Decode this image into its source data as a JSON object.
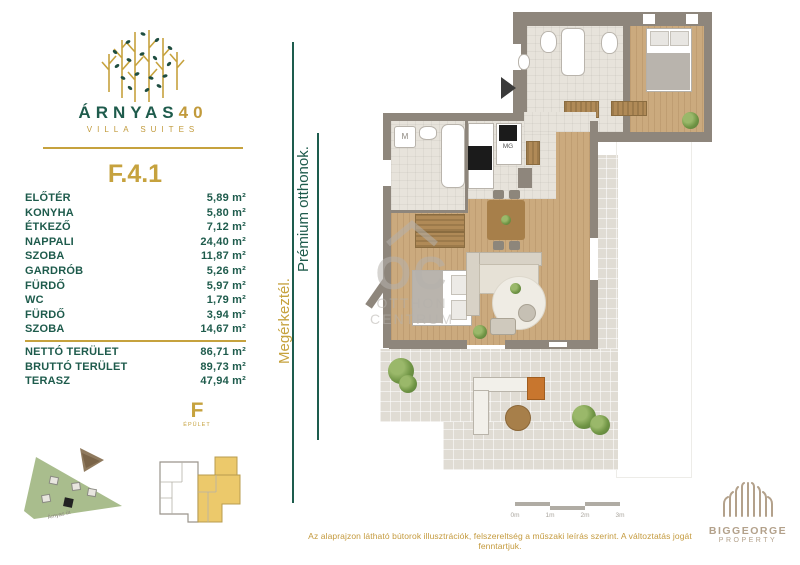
{
  "brand": {
    "name": "ÁRNYAS",
    "number": "40",
    "subtitle": "VILLA SUITES"
  },
  "unit": {
    "id": "F.4.1"
  },
  "rooms": [
    {
      "label": "ELŐTÉR",
      "value": "5,89 m²"
    },
    {
      "label": "KONYHA",
      "value": "5,80 m²"
    },
    {
      "label": "ÉTKEZŐ",
      "value": "7,12 m²"
    },
    {
      "label": "NAPPALI",
      "value": "24,40 m²"
    },
    {
      "label": "SZOBA",
      "value": "11,87 m²"
    },
    {
      "label": "GARDRÓB",
      "value": "5,26 m²"
    },
    {
      "label": "FÜRDŐ",
      "value": "5,97 m²"
    },
    {
      "label": "WC",
      "value": "1,79 m²"
    },
    {
      "label": "FÜRDŐ",
      "value": "3,94 m²"
    },
    {
      "label": "SZOBA",
      "value": "14,67 m²"
    }
  ],
  "totals": [
    {
      "label": "NETTÓ TERÜLET",
      "value": "86,71 m²"
    },
    {
      "label": "BRUTTÓ TERÜLET",
      "value": "89,73 m²"
    },
    {
      "label": "TERASZ",
      "value": "47,94 m²"
    }
  ],
  "tagline": {
    "gold": "Megérkeztél.",
    "green": "Prémium otthonok."
  },
  "plan_labels": {
    "washing_machine": "M",
    "microwave": "MG"
  },
  "watermark": {
    "line1": "OC",
    "line2": "OTTHON",
    "line3": "CENTRUM"
  },
  "scalebar": {
    "ticks": [
      "0m",
      "1m",
      "2m",
      "3m"
    ]
  },
  "siteplan": {
    "street": "Árnyas út"
  },
  "keyplan": {
    "building": "F",
    "sub": "ÉPÜLET"
  },
  "disclaimer": "Az alaprajzon látható bútorok illusztrációk, felszereltség a műszaki leírás szerint. A változtatás jogát fenntartjuk.",
  "footer_logo": {
    "line1": "BIGGEORGE",
    "line2": "PROPERTY"
  },
  "colors": {
    "green": "#1E5B4C",
    "gold": "#C6A23E",
    "wall": "#8E867C",
    "wood": "#CBAA7E",
    "tile": "#E7E3DB",
    "terrace": "#E0DCD4",
    "watermark_gray": "#B5B1AC",
    "footer_tan": "#B3A18B"
  }
}
